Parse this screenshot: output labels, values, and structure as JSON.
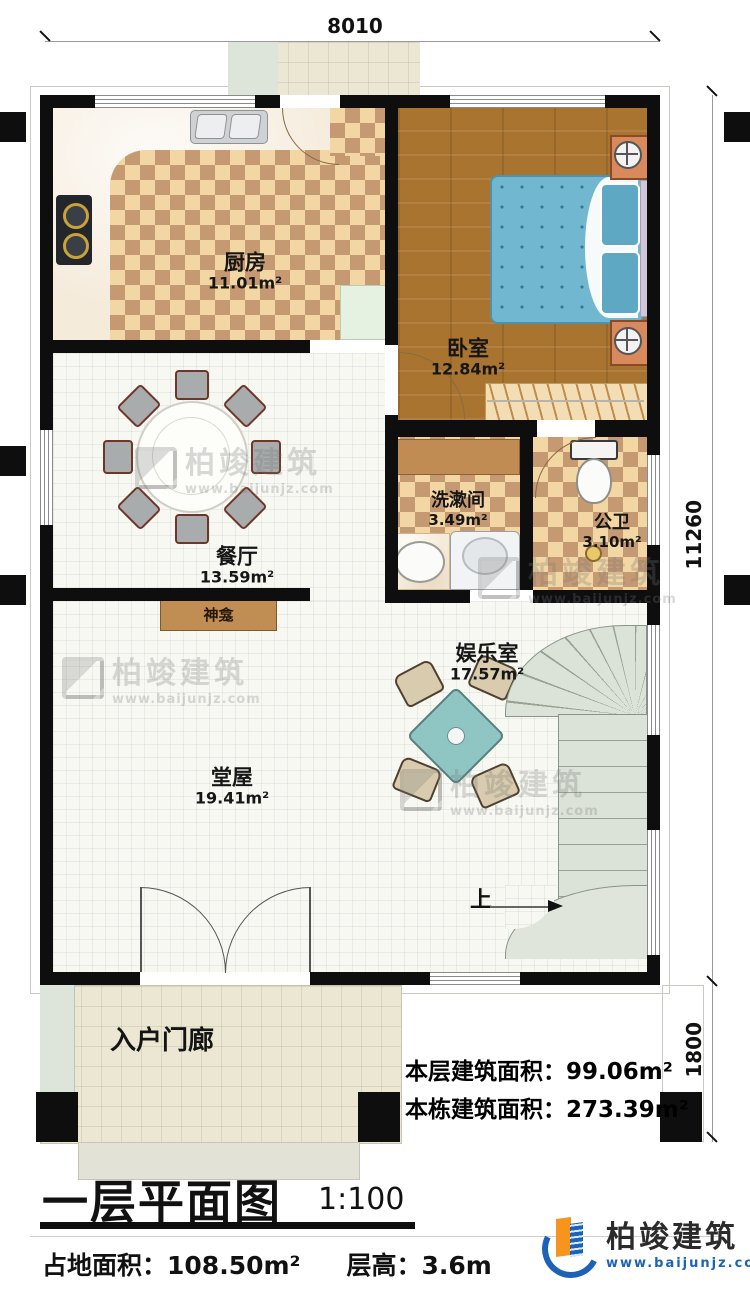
{
  "dimensions": {
    "top": "8010",
    "side_upper": "11260",
    "side_lower": "1800"
  },
  "rooms": {
    "kitchen": {
      "name": "厨房",
      "area": "11.01m²"
    },
    "bedroom": {
      "name": "卧室",
      "area": "12.84m²"
    },
    "dining": {
      "name": "餐厅",
      "area": "13.59m²"
    },
    "washroom": {
      "name": "洗漱间",
      "area": "3.49m²"
    },
    "toilet": {
      "name": "公卫",
      "area": "3.10m²"
    },
    "entertainment": {
      "name": "娱乐室",
      "area": "17.57m²"
    },
    "hall": {
      "name": "堂屋",
      "area": "19.41m²"
    }
  },
  "labels": {
    "shrine": "神龛",
    "stairs_up": "上",
    "porch": "入户门廊"
  },
  "stats": {
    "floor_area_label": "本层建筑面积：",
    "floor_area_value": "99.06m²",
    "building_area_label": "本栋建筑面积：",
    "building_area_value": "273.39m²"
  },
  "titleblock": {
    "title": "一层平面图",
    "scale": "1:100",
    "site_area_label": "占地面积：",
    "site_area_value": "108.50m²",
    "storey_height_label": "层高：",
    "storey_height_value": "3.6m"
  },
  "logo": {
    "name": "柏竣建筑",
    "website": "www.baijunjz.com"
  },
  "watermark": {
    "name": "柏竣建筑",
    "website": "www.baijunjz.com"
  },
  "colors": {
    "wall": "#0e0e0e",
    "logo_blue": "#1c63b7",
    "logo_orange": "#f7941d"
  }
}
